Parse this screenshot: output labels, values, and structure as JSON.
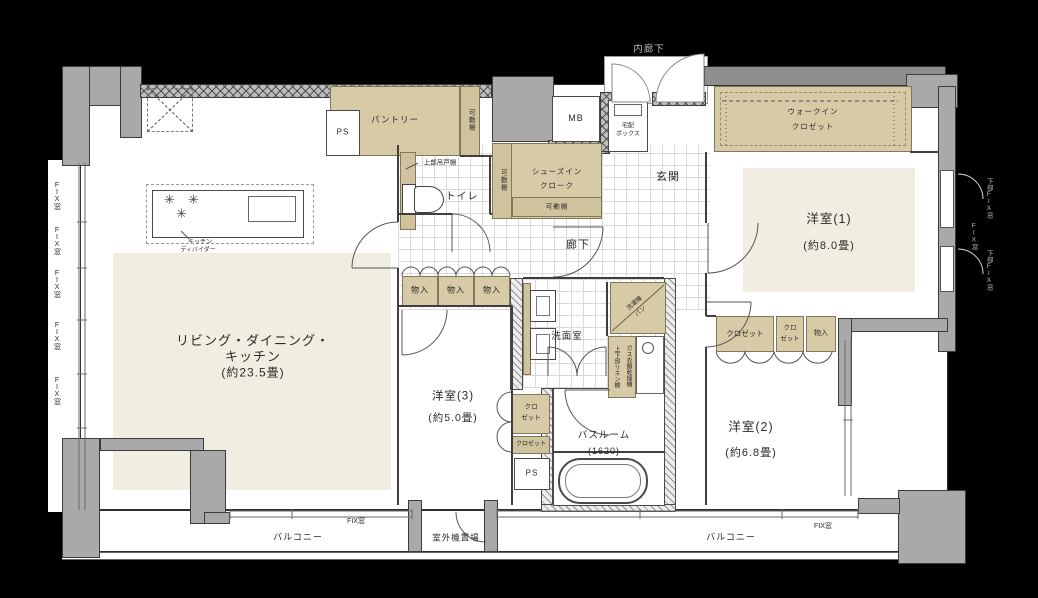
{
  "rooms": {
    "ldk": {
      "label_line1": "リビング・ダイニング・",
      "label_line2": "キッチン",
      "size": "(約23.5畳)"
    },
    "bedroom1": {
      "label": "洋室(1)",
      "size": "(約8.0畳)"
    },
    "bedroom2": {
      "label": "洋室(2)",
      "size": "(約6.8畳)"
    },
    "bedroom3": {
      "label": "洋室(3)",
      "size": "(約5.0畳)"
    },
    "bathroom": {
      "label": "バスルーム",
      "size": "(1620)"
    },
    "washroom": {
      "label": "洗面室"
    },
    "toilet": {
      "label": "トイレ"
    },
    "genkan": {
      "label": "玄関"
    },
    "hallway": {
      "label": "廊下"
    },
    "inner_corridor": {
      "label": "内廊下"
    },
    "pantry": {
      "label": "パントリー"
    },
    "shoes_in_closet": {
      "line1": "シューズイン",
      "line2": "クローク"
    },
    "walk_in_closet": {
      "line1": "ウォークイン",
      "line2": "クロゼット"
    },
    "balcony": {
      "label": "バルコニー"
    },
    "outdoor_unit": {
      "label": "室外機置場"
    }
  },
  "storage": {
    "movable_shelf": "可動棚",
    "upper_cabinet": "上部吊戸棚",
    "storage_box": "物入",
    "closet": "クロゼット",
    "closet_line1": "クロ",
    "closet_line2": "ゼット",
    "linen_shelf": "上下部リネン棚"
  },
  "equipment": {
    "meter_box": "MB",
    "pipe_space": "PS",
    "delivery_line1": "宅配",
    "delivery_line2": "ボックス",
    "kitchen_divider_line1": "キッチン",
    "kitchen_divider_line2": "ディバイダー",
    "laundry_pan_line1": "洗濯機",
    "laundry_pan_line2": "パン",
    "gas_dryer": "ガス衣類乾燥機"
  },
  "windows": {
    "fix": "FIX窓",
    "lower_fix": "下部FIX窓"
  },
  "colors": {
    "background": "#000000",
    "floor": "#ffffff",
    "wall": "#a9a9a9",
    "storage_fill": "#d6caa7",
    "accent_floor": "#f1eee1",
    "outline": "#3c3c3c",
    "label": "#2d2a26",
    "light_label": "#bdbab5"
  }
}
